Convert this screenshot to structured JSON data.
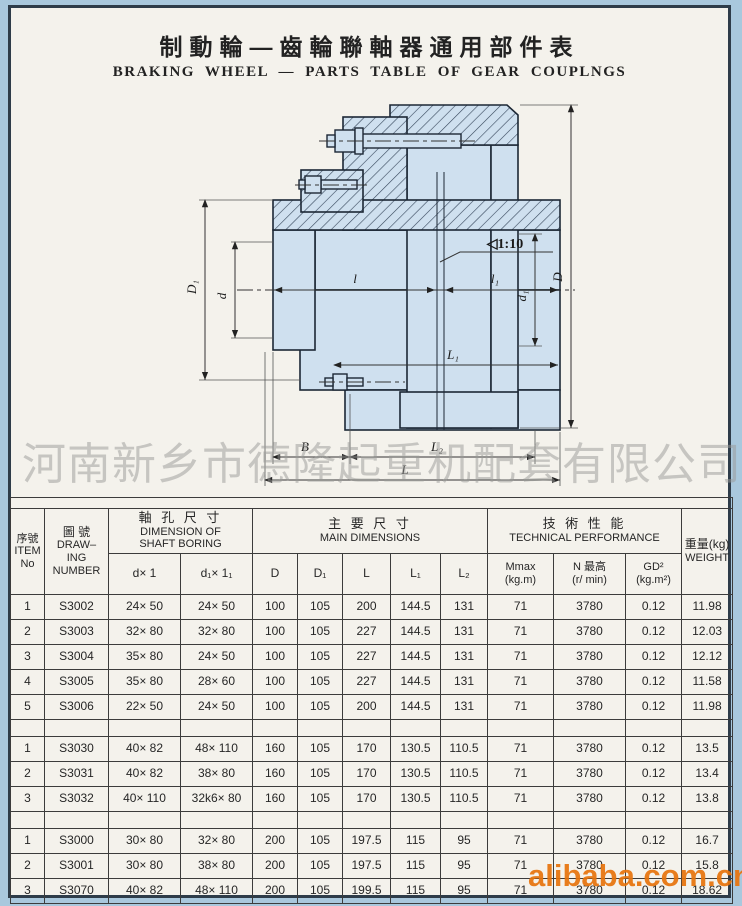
{
  "title": {
    "zh": "制動輪—齒輪聯軸器通用部件表",
    "en": "BRAKING WHEEL — PARTS TABLE OF GEAR COUPLNGS"
  },
  "watermarks": {
    "company": "河南新乡市德隆起重机配套有限公司",
    "site": "alibaba.com.cn"
  },
  "drawing": {
    "labels": {
      "D1": "D₁",
      "d": "d",
      "taper": "◁1:10",
      "d1": "d₁",
      "D": "D",
      "l": "l",
      "l1": "l₁",
      "L1": "L₁",
      "B": "B",
      "L2": "L₂",
      "L": "L"
    }
  },
  "table": {
    "header": {
      "item": [
        "序號",
        "ITEM",
        "No"
      ],
      "drawing": [
        "圖  號",
        "DRAW–",
        "ING",
        "NUMBER"
      ],
      "boring_zh": "軸 孔 尺 寸",
      "boring_en1": "DIMENSION OF",
      "boring_en2": "SHAFT BORING",
      "main_zh": "主 要 尺 寸",
      "main_en": "MAIN DIMENSIONS",
      "tech_zh": "技 術 性 能",
      "tech_en": "TECHNICAL PERFORMANCE",
      "weight": [
        "重量(kg)",
        "WEIGHT"
      ],
      "sub": [
        "d× 1",
        "d₁× 1₁",
        "D",
        "D₁",
        "L",
        "L₁",
        "L₂"
      ],
      "mmax": [
        "Mmax",
        "(kg.m)"
      ],
      "nmax": [
        "N 最高",
        "(r/ min)"
      ],
      "gd2": [
        "GD²",
        "(kg.m²)"
      ]
    },
    "groups": [
      {
        "rows": [
          [
            "1",
            "S3002",
            "24× 50",
            "24× 50",
            "100",
            "105",
            "200",
            "144.5",
            "131",
            "71",
            "3780",
            "0.12",
            "11.98"
          ],
          [
            "2",
            "S3003",
            "32× 80",
            "32× 80",
            "100",
            "105",
            "227",
            "144.5",
            "131",
            "71",
            "3780",
            "0.12",
            "12.03"
          ],
          [
            "3",
            "S3004",
            "35× 80",
            "24× 50",
            "100",
            "105",
            "227",
            "144.5",
            "131",
            "71",
            "3780",
            "0.12",
            "12.12"
          ],
          [
            "4",
            "S3005",
            "35× 80",
            "28× 60",
            "100",
            "105",
            "227",
            "144.5",
            "131",
            "71",
            "3780",
            "0.12",
            "11.58"
          ],
          [
            "5",
            "S3006",
            "22× 50",
            "24× 50",
            "100",
            "105",
            "200",
            "144.5",
            "131",
            "71",
            "3780",
            "0.12",
            "11.98"
          ]
        ]
      },
      {
        "rows": [
          [
            "1",
            "S3030",
            "40× 82",
            "48× 110",
            "160",
            "105",
            "170",
            "130.5",
            "110.5",
            "71",
            "3780",
            "0.12",
            "13.5"
          ],
          [
            "2",
            "S3031",
            "40× 82",
            "38× 80",
            "160",
            "105",
            "170",
            "130.5",
            "110.5",
            "71",
            "3780",
            "0.12",
            "13.4"
          ],
          [
            "3",
            "S3032",
            "40× 110",
            "32k6× 80",
            "160",
            "105",
            "170",
            "130.5",
            "110.5",
            "71",
            "3780",
            "0.12",
            "13.8"
          ]
        ]
      },
      {
        "rows": [
          [
            "1",
            "S3000",
            "30× 80",
            "32× 80",
            "200",
            "105",
            "197.5",
            "115",
            "95",
            "71",
            "3780",
            "0.12",
            "16.7"
          ],
          [
            "2",
            "S3001",
            "30× 80",
            "38× 80",
            "200",
            "105",
            "197.5",
            "115",
            "95",
            "71",
            "3780",
            "0.12",
            "15.8"
          ],
          [
            "3",
            "S3070",
            "40× 82",
            "48× 110",
            "200",
            "105",
            "199.5",
            "115",
            "95",
            "71",
            "3780",
            "0.12",
            "18.62"
          ]
        ]
      }
    ]
  },
  "colors": {
    "scan_background": "#a9c8dd",
    "paper": "#f4f2ec",
    "drawing_fill": "#cfe0ef",
    "hatch_line": "#35455a",
    "table_line": "#3c3c3c",
    "watermark_gray": "#9a9a98",
    "watermark_orange": "#e8740c",
    "ink": "#2b2b2b"
  }
}
